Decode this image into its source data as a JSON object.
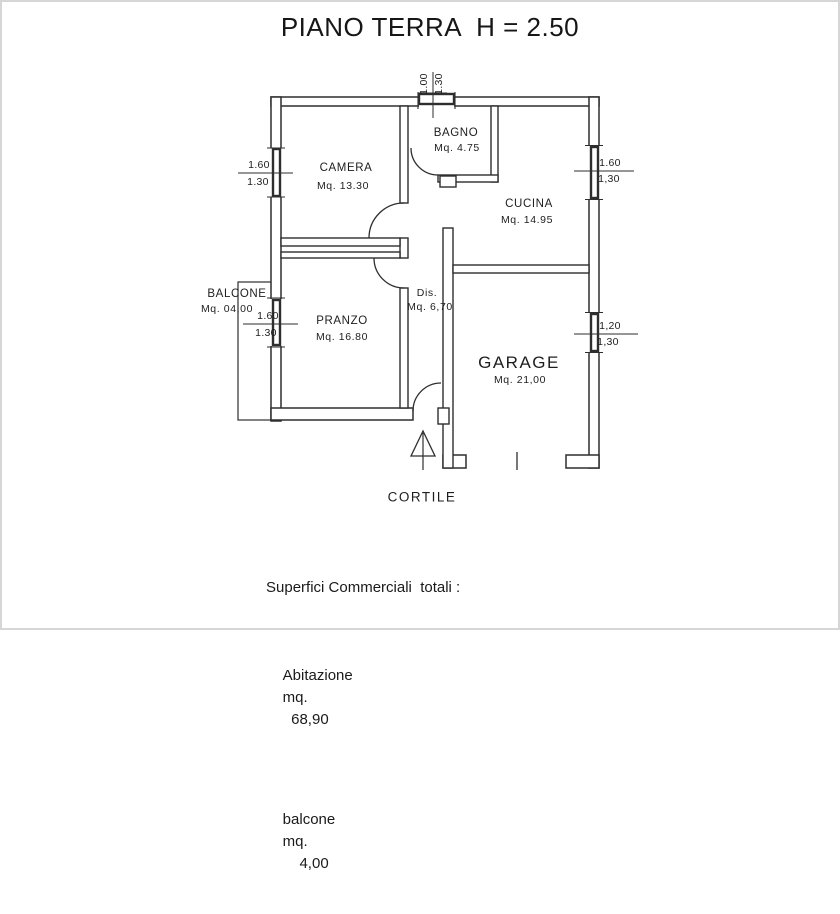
{
  "title": "PIANO TERRA  H = 2.50",
  "rooms": {
    "camera": {
      "name": "CAMERA",
      "area": "Mq. 13.30"
    },
    "bagno": {
      "name": "BAGNO",
      "area": "Mq. 4.75"
    },
    "cucina": {
      "name": "CUCINA",
      "area": "Mq. 14.95"
    },
    "pranzo": {
      "name": "PRANZO",
      "area": "Mq. 16.80"
    },
    "dis": {
      "name": "Dis.",
      "area": "Mq. 6,70"
    },
    "garage": {
      "name": "GARAGE",
      "area": "Mq. 21,00"
    },
    "balcone": {
      "name": "BALCONE",
      "area": "Mq. 04,00"
    },
    "cortile": {
      "name": "CORTILE"
    }
  },
  "dimensions": {
    "top_window": {
      "width": "1.00",
      "height": "1.30"
    },
    "camera_window": {
      "width": "1.60",
      "height": "1.30"
    },
    "pranzo_window": {
      "width": "1.60",
      "height": "1.30"
    },
    "cucina_window": {
      "width": "1.60",
      "height": "1,30"
    },
    "garage_window": {
      "width": "1,20",
      "height": "1,30"
    }
  },
  "summary": {
    "heading": "Superfici Commerciali  totali :",
    "rows": [
      {
        "label": "Abitazione",
        "unit": "mq.",
        "value": "68,90"
      },
      {
        "label": "balcone",
        "unit": "mq.",
        "value": "4,00"
      }
    ]
  },
  "colors": {
    "line": "#2e2e2e",
    "text": "#1e1e1e",
    "background": "#ffffff",
    "frame": "#d6d6d6"
  }
}
